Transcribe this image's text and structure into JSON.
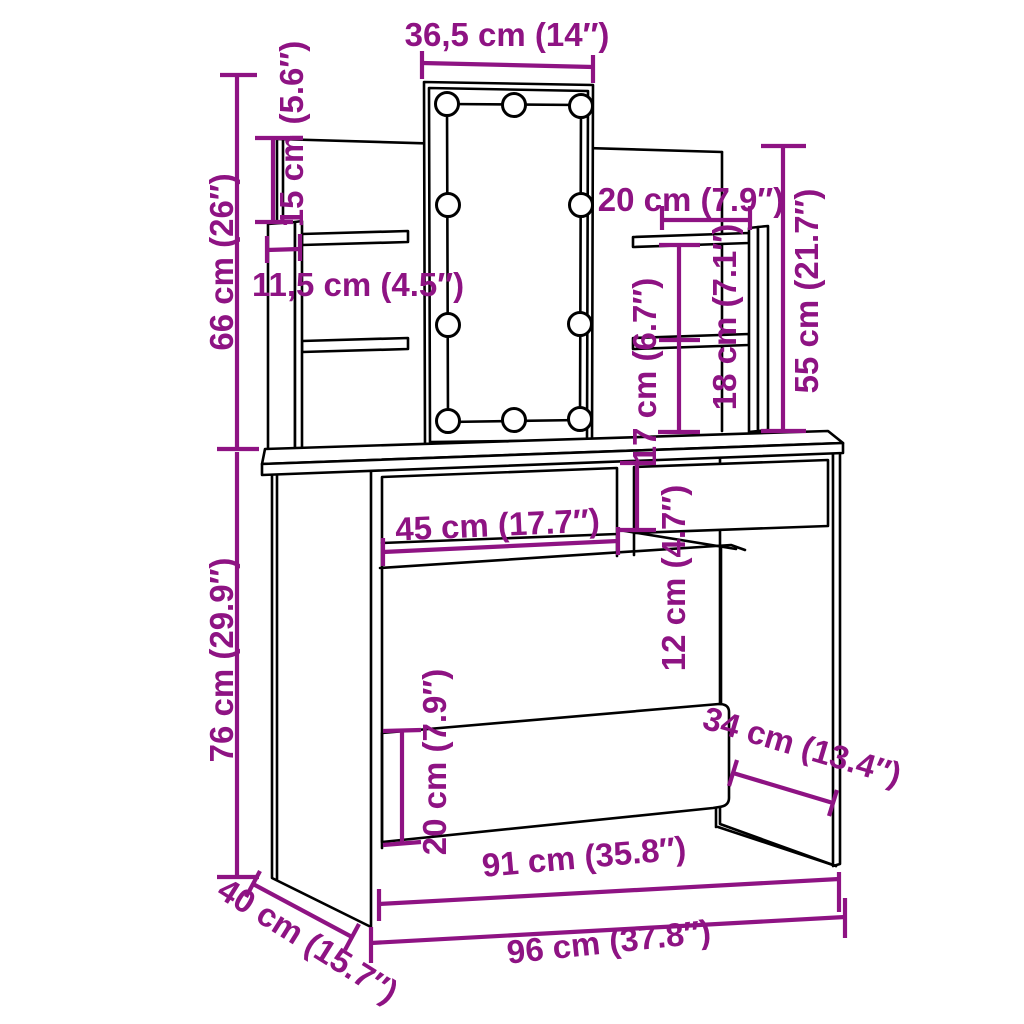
{
  "diagram": {
    "type": "furniture-dimension-diagram",
    "subject": "dressing table with LED mirror, shelves and drawers",
    "accent_color": "#8E1383",
    "line_color": "#000000",
    "background_color": "#FFFFFF",
    "led_bulb_count": 10,
    "dimensions": {
      "mirror_width": "36,5 cm (14″)",
      "back_panel_top_offset": "15 cm (5.6″)",
      "upper_section_height": "66 cm (26″)",
      "shelf_depth": "11,5 cm (4.5″)",
      "right_shelf_width": "20 cm (7.9″)",
      "back_panel_height": "55 cm (21.7″)",
      "shelf_gap_upper": "18 cm (7.1″)",
      "shelf_gap_lower": "17 cm (6.7″)",
      "drawer_height": "12 cm (4.7″)",
      "drawer_width": "45 cm (17.7″)",
      "table_height": "76 cm (29.9″)",
      "modesty_panel_height": "20 cm (7.9″)",
      "side_depth": "40 cm (15.7″)",
      "panel_side_depth": "34 cm (13.4″)",
      "inner_width": "91 cm (35.8″)",
      "total_width": "96 cm (37.8″)"
    }
  }
}
